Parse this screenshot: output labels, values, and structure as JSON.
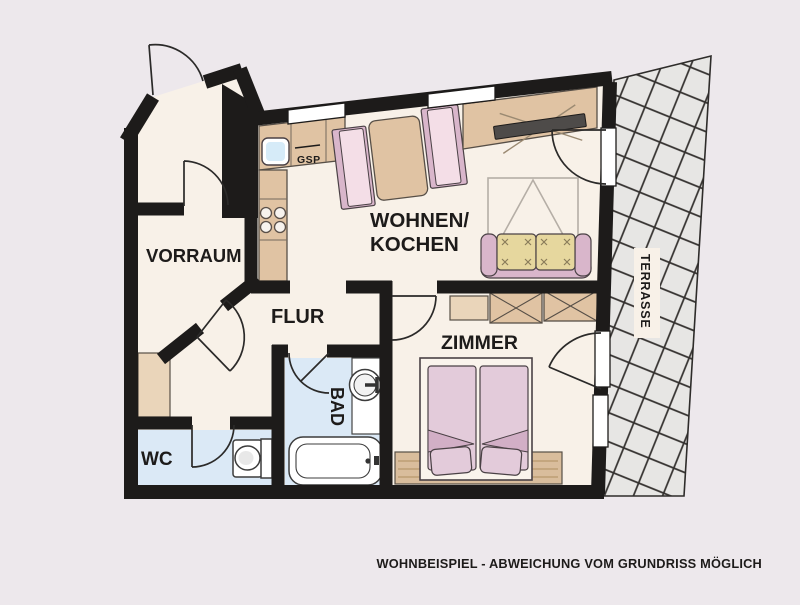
{
  "floorplan": {
    "rooms": {
      "vorraum": "VORRAUM",
      "wohnen_kochen_line1": "WOHNEN/",
      "wohnen_kochen_line2": "KOCHEN",
      "flur": "FLUR",
      "zimmer": "ZIMMER",
      "bad": "BAD",
      "wc": "WC",
      "terrasse": "TERRASSE"
    },
    "appliances": {
      "dishwasher_label": "GSP"
    },
    "caption": "WOHNBEISPIEL - ABWEICHUNG VOM GRUNDRISS MÖGLICH"
  },
  "colors": {
    "bg": "#EDE8EC",
    "floor": "#F8F1E8",
    "wall": "#1d1b1a",
    "bathfloor": "#DBE9F6",
    "counter": "#E0C3A3",
    "pink": "#ECCBDA",
    "cushion": "#E6D79E",
    "terrace": "#E7E6E4",
    "caption_text": "#3a3440"
  }
}
